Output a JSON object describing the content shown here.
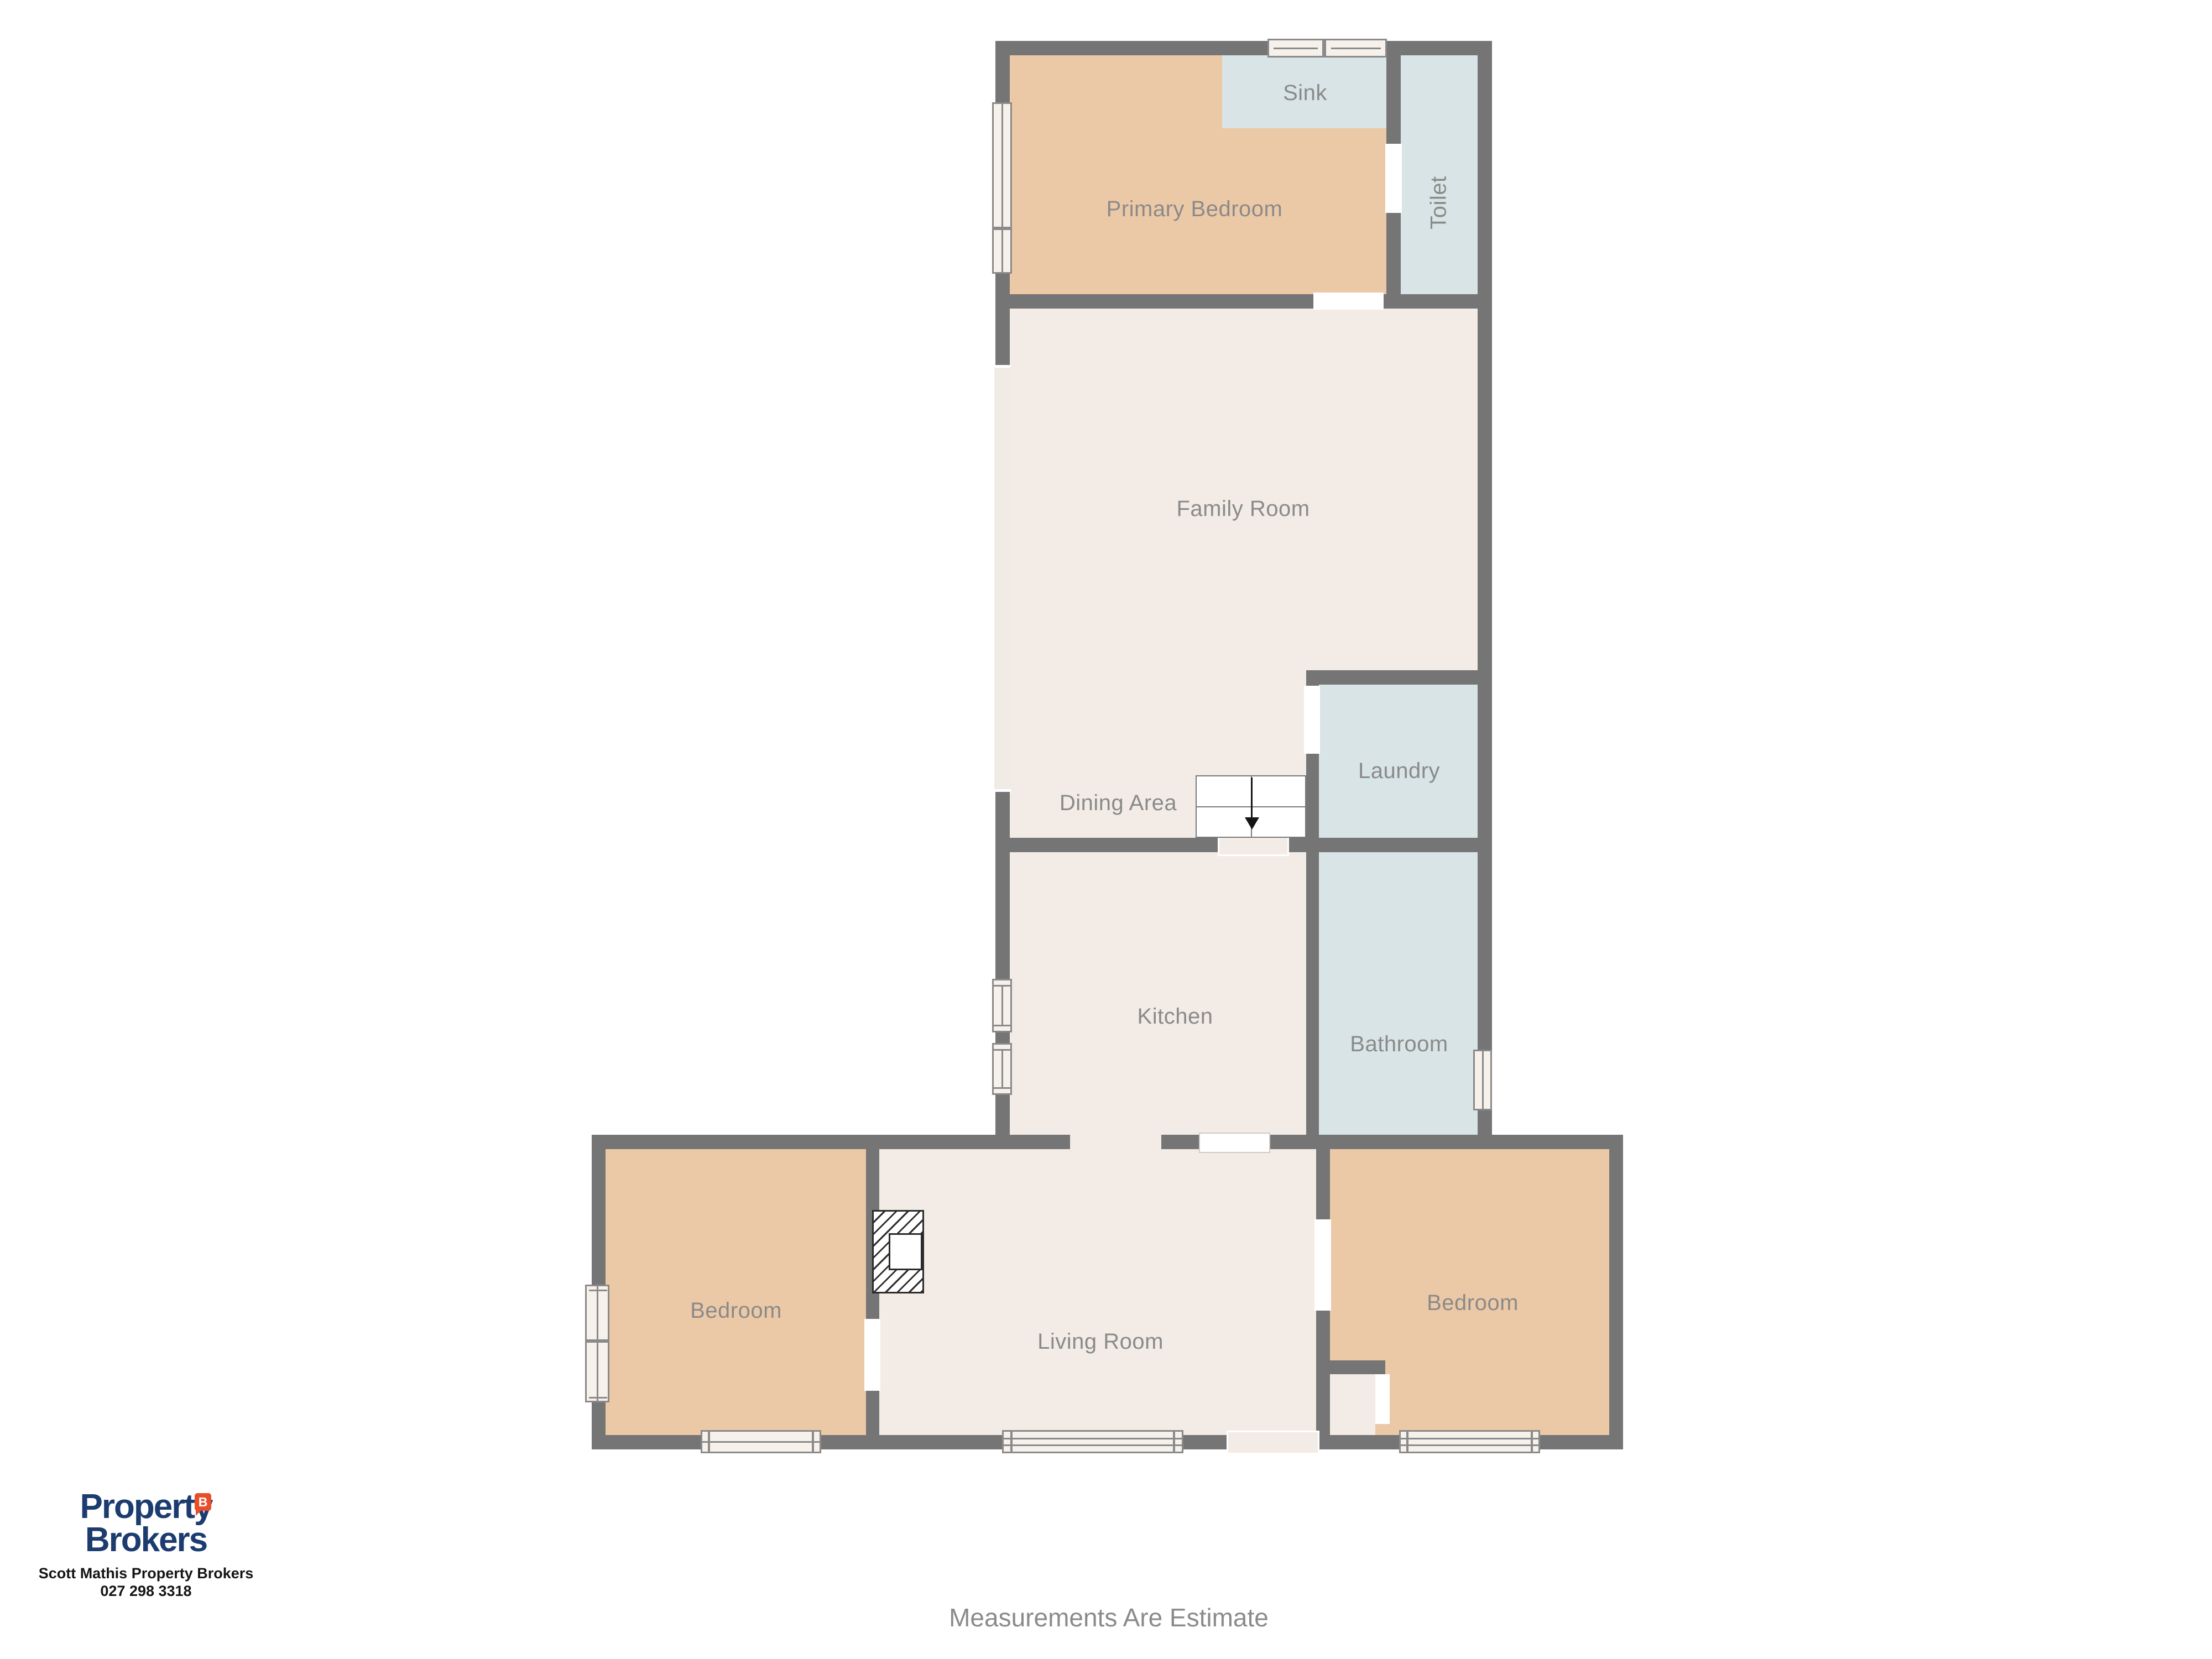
{
  "page": {
    "background": "#ffffff"
  },
  "floorplan": {
    "colors": {
      "wall": "#757575",
      "room_fill": "#f3ece6",
      "bedroom_fill": "#ecc9a6",
      "wet_area_fill": "#d8e4e5",
      "label_text": "#8a8a8a",
      "window_strip": "#f1ebe5",
      "window_frame_border": "#8a8a8a",
      "window_frame_fill": "#f6f1eb"
    },
    "rooms": {
      "sink": {
        "label": "Sink"
      },
      "toilet": {
        "label": "Toilet"
      },
      "primary_bedroom": {
        "label": "Primary Bedroom"
      },
      "family_room": {
        "label": "Family Room"
      },
      "laundry": {
        "label": "Laundry"
      },
      "dining_area": {
        "label": "Dining Area"
      },
      "kitchen": {
        "label": "Kitchen"
      },
      "bathroom": {
        "label": "Bathroom"
      },
      "bedroom_left": {
        "label": "Bedroom"
      },
      "living_room": {
        "label": "Living Room"
      },
      "bedroom_right": {
        "label": "Bedroom"
      }
    },
    "stairs": {
      "direction": "down"
    }
  },
  "branding": {
    "logo_line1": "Property",
    "logo_line2": "Brokers",
    "logo_badge_letter": "B",
    "agent_line": "Scott Mathis Property Brokers",
    "phone": "027 298 3318",
    "navy": "#1c3c6f",
    "orange": "#e94e2b"
  },
  "footer": {
    "disclaimer": "Measurements Are Estimate"
  }
}
